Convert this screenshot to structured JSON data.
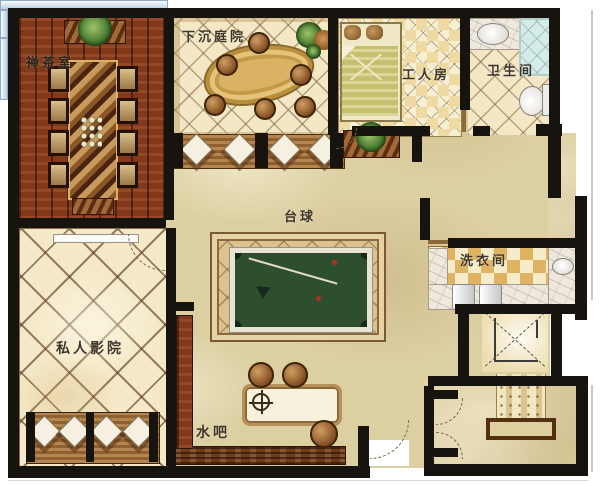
{
  "labels": {
    "tea_room": "禅茶室",
    "sunken_courtyard": "下沉庭院",
    "worker_room": "工人房",
    "bathroom": "卫生间",
    "billiards": "台球",
    "laundry_room": "洗衣间",
    "private_cinema": "私人影院",
    "water_bar": "水吧"
  },
  "colors": {
    "wall": "#17130e",
    "tea_room_wood": "#82391b",
    "hall_floor": "#dccfa2",
    "lattice_floor": "#f3e7c6",
    "gold_tile": "#e0b363",
    "billiard_felt": "#2d4f2d",
    "shower_glass": "#d4ebe7",
    "bed_green": "#c6c06e",
    "marble": "#efe8dd"
  }
}
